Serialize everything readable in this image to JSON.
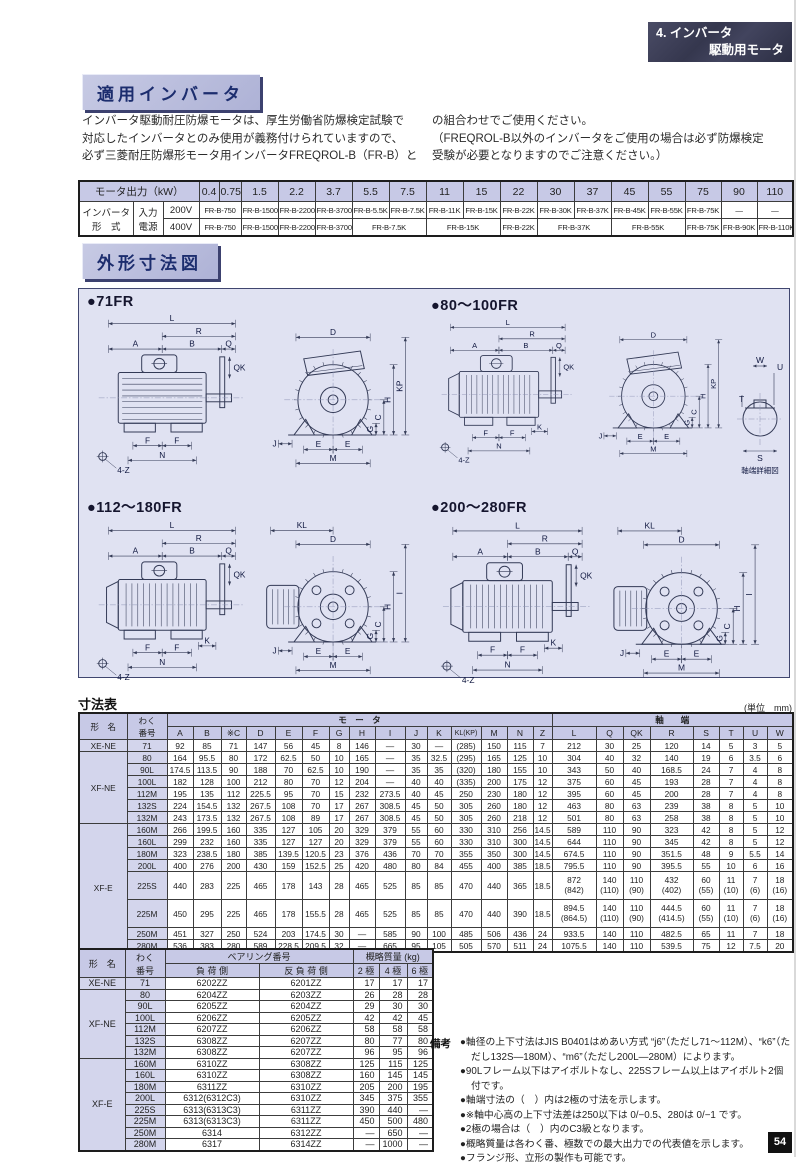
{
  "page": {
    "number": "54"
  },
  "corner_badge": {
    "line1": "4. インバータ",
    "line2": "駆動用モータ"
  },
  "section1": {
    "title": "適用インバータ",
    "intro_left": [
      "インバータ駆動耐圧防爆モータは、厚生労働省防爆検定試験で",
      "対応したインバータとのみ使用が義務付けられていますので、",
      "必ず三菱耐圧防爆形モータ用インバータFREQROL-B（FR-B）と"
    ],
    "intro_right": [
      "の組合わせでご使用ください。",
      "（FREQROL-B以外のインバータをご使用の場合は必ず防爆検定",
      "受験が必要となりますのでご注意ください。）"
    ]
  },
  "inverter_table": {
    "output_header": "モータ出力（kW）",
    "outputs": [
      "0.4",
      "0.75",
      "1.5",
      "2.2",
      "3.7",
      "5.5",
      "7.5",
      "11",
      "15",
      "22",
      "30",
      "37",
      "45",
      "55",
      "75",
      "90",
      "110"
    ],
    "left_label_1": "インバータ\n形　式",
    "left_label_2": "入力\n電源",
    "rows": [
      {
        "voltage": "200V",
        "cells": [
          {
            "t": "FR-B-750",
            "s": 2
          },
          {
            "t": "FR-B-1500",
            "s": 1
          },
          {
            "t": "FR-B-2200",
            "s": 1
          },
          {
            "t": "FR-B-3700",
            "s": 1
          },
          {
            "t": "FR-B-5.5K",
            "s": 1
          },
          {
            "t": "FR-B-7.5K",
            "s": 1
          },
          {
            "t": "FR-B-11K",
            "s": 1
          },
          {
            "t": "FR-B-15K",
            "s": 1
          },
          {
            "t": "FR-B-22K",
            "s": 1
          },
          {
            "t": "FR-B-30K",
            "s": 1
          },
          {
            "t": "FR-B-37K",
            "s": 1
          },
          {
            "t": "FR-B-45K",
            "s": 1
          },
          {
            "t": "FR-B-55K",
            "s": 1
          },
          {
            "t": "FR-B-75K",
            "s": 1
          },
          {
            "t": "―",
            "s": 1
          },
          {
            "t": "―",
            "s": 1
          }
        ]
      },
      {
        "voltage": "400V",
        "cells": [
          {
            "t": "FR-B-750",
            "s": 2
          },
          {
            "t": "FR-B-1500",
            "s": 1
          },
          {
            "t": "FR-B-2200",
            "s": 1
          },
          {
            "t": "FR-B-3700",
            "s": 1
          },
          {
            "t": "FR-B-7.5K",
            "s": 2
          },
          {
            "t": "FR-B-15K",
            "s": 2
          },
          {
            "t": "FR-B-22K",
            "s": 1
          },
          {
            "t": "FR-B-37K",
            "s": 2
          },
          {
            "t": "FR-B-55K",
            "s": 2
          },
          {
            "t": "FR-B-75K",
            "s": 1
          },
          {
            "t": "FR-B-90K",
            "s": 1
          },
          {
            "t": "FR-B-110K",
            "s": 1
          }
        ]
      }
    ]
  },
  "section2": {
    "title": "外形寸法図",
    "drawings": [
      {
        "title": "●71FR",
        "labels": {
          "L": "L",
          "R": "R",
          "A": "A",
          "B": "B",
          "Q": "Q",
          "QK": "QK",
          "F1": "F",
          "F2": "F",
          "N": "N",
          "K": "",
          "Z4": "4-Z",
          "KL": "",
          "D": "D",
          "V1": "KP",
          "H": "H",
          "C": "C",
          "G": "G",
          "J": "J",
          "E1": "E",
          "E2": "E",
          "M": "M"
        }
      },
      {
        "title": "●80～100FR",
        "labels": {
          "L": "L",
          "R": "R",
          "A": "A",
          "B": "B",
          "Q": "Q",
          "QK": "QK",
          "F1": "F",
          "F2": "F",
          "N": "N",
          "K": "K",
          "Z4": "4-Z",
          "KL": "",
          "D": "D",
          "V1": "KP",
          "H": "H",
          "C": "C",
          "G": "G",
          "J": "J",
          "E1": "E",
          "E2": "E",
          "M": "M"
        }
      },
      {
        "title": "●112～180FR",
        "labels": {
          "L": "L",
          "R": "R",
          "A": "A",
          "B": "B",
          "Q": "Q",
          "QK": "QK",
          "F1": "F",
          "F2": "F",
          "N": "N",
          "K": "K",
          "Z4": "4-Z",
          "KL": "KL",
          "D": "D",
          "V1": "I",
          "H": "H",
          "C": "C",
          "G": "G",
          "J": "J",
          "E1": "E",
          "E2": "E",
          "M": "M"
        }
      },
      {
        "title": "●200～280FR",
        "labels": {
          "L": "L",
          "R": "R",
          "A": "A",
          "B": "B",
          "Q": "Q",
          "QK": "QK",
          "F1": "F",
          "F2": "F",
          "N": "N",
          "K": "K",
          "Z4": "4-Z",
          "KL": "KL",
          "D": "D",
          "V1": "I",
          "H": "H",
          "C": "C",
          "G": "G",
          "J": "J",
          "E1": "E",
          "E2": "E",
          "M": "M"
        }
      }
    ],
    "shaft_detail": {
      "caption": "軸端詳細図",
      "W": "W",
      "U": "U",
      "T": "T",
      "S": "S"
    }
  },
  "dim_table": {
    "title": "寸法表",
    "unit": "(単位　mm)",
    "col_head_1": "形　名",
    "col_head_2": "わく\n番号",
    "group1_label": "モ　ー　タ",
    "group1_cols": [
      "A",
      "B",
      "※C",
      "D",
      "E",
      "F",
      "G",
      "H",
      "I",
      "J",
      "K",
      "KL(KP)",
      "M",
      "N",
      "Z"
    ],
    "group2_label": "軸　　端",
    "group2_cols": [
      "L",
      "Q",
      "QK",
      "R",
      "S",
      "T",
      "U",
      "W"
    ],
    "groups": [
      {
        "name": "XE-NE",
        "rows": [
          {
            "frame": "71",
            "v": [
              "92",
              "85",
              "71",
              "147",
              "56",
              "45",
              "8",
              "146",
              "―",
              "30",
              "―",
              "(285)",
              "150",
              "115",
              "7",
              "212",
              "30",
              "25",
              "120",
              "14",
              "5",
              "3",
              "5"
            ]
          }
        ]
      },
      {
        "name": "XF-NE",
        "rows": [
          {
            "frame": "80",
            "v": [
              "164",
              "95.5",
              "80",
              "172",
              "62.5",
              "50",
              "10",
              "165",
              "―",
              "35",
              "32.5",
              "(295)",
              "165",
              "125",
              "10",
              "304",
              "40",
              "32",
              "140",
              "19",
              "6",
              "3.5",
              "6"
            ]
          },
          {
            "frame": "90L",
            "v": [
              "174.5",
              "113.5",
              "90",
              "188",
              "70",
              "62.5",
              "10",
              "190",
              "―",
              "35",
              "35",
              "(320)",
              "180",
              "155",
              "10",
              "343",
              "50",
              "40",
              "168.5",
              "24",
              "7",
              "4",
              "8"
            ]
          },
          {
            "frame": "100L",
            "v": [
              "182",
              "128",
              "100",
              "212",
              "80",
              "70",
              "12",
              "204",
              "―",
              "40",
              "40",
              "(335)",
              "200",
              "175",
              "12",
              "375",
              "60",
              "45",
              "193",
              "28",
              "7",
              "4",
              "8"
            ]
          },
          {
            "frame": "112M",
            "v": [
              "195",
              "135",
              "112",
              "225.5",
              "95",
              "70",
              "15",
              "232",
              "273.5",
              "40",
              "45",
              "250",
              "230",
              "180",
              "12",
              "395",
              "60",
              "45",
              "200",
              "28",
              "7",
              "4",
              "8"
            ]
          },
          {
            "frame": "132S",
            "v": [
              "224",
              "154.5",
              "132",
              "267.5",
              "108",
              "70",
              "17",
              "267",
              "308.5",
              "45",
              "50",
              "305",
              "260",
              "180",
              "12",
              "463",
              "80",
              "63",
              "239",
              "38",
              "8",
              "5",
              "10"
            ]
          },
          {
            "frame": "132M",
            "v": [
              "243",
              "173.5",
              "132",
              "267.5",
              "108",
              "89",
              "17",
              "267",
              "308.5",
              "45",
              "50",
              "305",
              "260",
              "218",
              "12",
              "501",
              "80",
              "63",
              "258",
              "38",
              "8",
              "5",
              "10"
            ]
          }
        ]
      },
      {
        "name": "XF-E",
        "rows": [
          {
            "frame": "160M",
            "v": [
              "266",
              "199.5",
              "160",
              "335",
              "127",
              "105",
              "20",
              "329",
              "379",
              "55",
              "60",
              "330",
              "310",
              "256",
              "14.5",
              "589",
              "110",
              "90",
              "323",
              "42",
              "8",
              "5",
              "12"
            ]
          },
          {
            "frame": "160L",
            "v": [
              "299",
              "232",
              "160",
              "335",
              "127",
              "127",
              "20",
              "329",
              "379",
              "55",
              "60",
              "330",
              "310",
              "300",
              "14.5",
              "644",
              "110",
              "90",
              "345",
              "42",
              "8",
              "5",
              "12"
            ]
          },
          {
            "frame": "180M",
            "v": [
              "323",
              "238.5",
              "180",
              "385",
              "139.5",
              "120.5",
              "23",
              "376",
              "436",
              "70",
              "70",
              "355",
              "350",
              "300",
              "14.5",
              "674.5",
              "110",
              "90",
              "351.5",
              "48",
              "9",
              "5.5",
              "14"
            ]
          },
          {
            "frame": "200L",
            "v": [
              "400",
              "276",
              "200",
              "430",
              "159",
              "152.5",
              "25",
              "420",
              "480",
              "80",
              "84",
              "455",
              "400",
              "385",
              "18.5",
              "795.5",
              "110",
              "90",
              "395.5",
              "55",
              "10",
              "6",
              "16"
            ]
          },
          {
            "frame": "225S",
            "v": [
              "440",
              "283",
              "225",
              "465",
              "178",
              "143",
              "28",
              "465",
              "525",
              "85",
              "85",
              "470",
              "440",
              "365",
              "18.5",
              "872\n(842)",
              "140\n(110)",
              "110\n(90)",
              "432\n(402)",
              "60\n(55)",
              "11\n(10)",
              "7\n(6)",
              "18\n(16)"
            ]
          },
          {
            "frame": "225M",
            "v": [
              "450",
              "295",
              "225",
              "465",
              "178",
              "155.5",
              "28",
              "465",
              "525",
              "85",
              "85",
              "470",
              "440",
              "390",
              "18.5",
              "894.5\n(864.5)",
              "140\n(110)",
              "110\n(90)",
              "444.5\n(414.5)",
              "60\n(55)",
              "11\n(10)",
              "7\n(6)",
              "18\n(16)"
            ]
          },
          {
            "frame": "250M",
            "v": [
              "451",
              "327",
              "250",
              "524",
              "203",
              "174.5",
              "30",
              "―",
              "585",
              "90",
              "100",
              "485",
              "506",
              "436",
              "24",
              "933.5",
              "140",
              "110",
              "482.5",
              "65",
              "11",
              "7",
              "18"
            ]
          },
          {
            "frame": "280M",
            "v": [
              "536",
              "383",
              "280",
              "589",
              "228.5",
              "209.5",
              "32",
              "―",
              "665",
              "95",
              "105",
              "505",
              "570",
              "511",
              "24",
              "1075.5",
              "140",
              "110",
              "539.5",
              "75",
              "12",
              "7.5",
              "20"
            ]
          }
        ]
      }
    ]
  },
  "bearing_table": {
    "col_head_1": "形　名",
    "col_head_2": "わく\n番号",
    "bearing_group": "ベアリング番号",
    "load_side": "負 荷 側",
    "antiload_side": "反 負 荷 側",
    "mass_group": "概略質量 (kg)",
    "poles": [
      "2 極",
      "4 極",
      "6 極"
    ],
    "groups": [
      {
        "name": "XE-NE",
        "rows": [
          {
            "frame": "71",
            "v": [
              "6202ZZ",
              "6201ZZ",
              "17",
              "17",
              "17"
            ]
          }
        ]
      },
      {
        "name": "XF-NE",
        "rows": [
          {
            "frame": "80",
            "v": [
              "6204ZZ",
              "6203ZZ",
              "26",
              "28",
              "28"
            ]
          },
          {
            "frame": "90L",
            "v": [
              "6205ZZ",
              "6204ZZ",
              "29",
              "30",
              "30"
            ]
          },
          {
            "frame": "100L",
            "v": [
              "6206ZZ",
              "6205ZZ",
              "42",
              "42",
              "45"
            ]
          },
          {
            "frame": "112M",
            "v": [
              "6207ZZ",
              "6206ZZ",
              "58",
              "58",
              "58"
            ]
          },
          {
            "frame": "132S",
            "v": [
              "6308ZZ",
              "6207ZZ",
              "80",
              "77",
              "80"
            ]
          },
          {
            "frame": "132M",
            "v": [
              "6308ZZ",
              "6207ZZ",
              "96",
              "95",
              "96"
            ]
          }
        ]
      },
      {
        "name": "XF-E",
        "rows": [
          {
            "frame": "160M",
            "v": [
              "6310ZZ",
              "6308ZZ",
              "125",
              "115",
              "125"
            ]
          },
          {
            "frame": "160L",
            "v": [
              "6310ZZ",
              "6308ZZ",
              "160",
              "145",
              "145"
            ]
          },
          {
            "frame": "180M",
            "v": [
              "6311ZZ",
              "6310ZZ",
              "205",
              "200",
              "195"
            ]
          },
          {
            "frame": "200L",
            "v": [
              "6312(6312C3)",
              "6310ZZ",
              "345",
              "375",
              "355"
            ]
          },
          {
            "frame": "225S",
            "v": [
              "6313(6313C3)",
              "6311ZZ",
              "390",
              "440",
              "―"
            ]
          },
          {
            "frame": "225M",
            "v": [
              "6313(6313C3)",
              "6311ZZ",
              "450",
              "500",
              "480"
            ]
          },
          {
            "frame": "250M",
            "v": [
              "6314",
              "6312ZZ",
              "―",
              "650",
              "―"
            ]
          },
          {
            "frame": "280M",
            "v": [
              "6317",
              "6314ZZ",
              "―",
              "1000",
              "―"
            ]
          }
        ]
      }
    ]
  },
  "notes": {
    "label": "備考",
    "items": [
      "●軸径の上下寸法はJIS B0401はめあい方式 “j6”（ただし71～112M）、“k6”（ただし132S―180M）、“m6”（ただし200L―280M）によります。",
      "●90Lフレーム以下はアイボルトなし、225Sフレーム以上はアイボルト2個付です。",
      "●軸端寸法の（　）内は2極の寸法を示します。",
      "●※軸中心高の上下寸法差は250以下は 0/−0.5、280は 0/−1 です。",
      "●2極の場合は（　）内のC3級となります。",
      "●概略質量は各わく番、極数での最大出力での代表値を示します。",
      "●フランジ形、立形の製作も可能です。"
    ]
  },
  "colors": {
    "accent_lavender": "#c7c9e6",
    "panel_bg": "#e0e2f2",
    "title_text": "#1c2d6e",
    "badge_bg": "#35374e"
  }
}
